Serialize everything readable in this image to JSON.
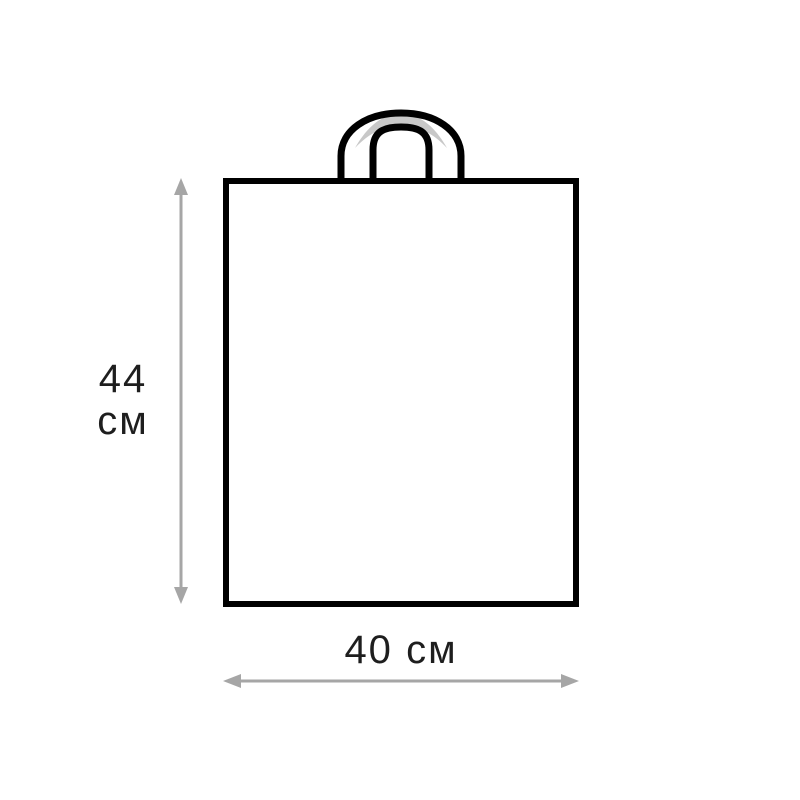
{
  "colors": {
    "outline": "#000000",
    "arrow": "#a6a6a6",
    "handle-fill": "#c8c8c8",
    "text": "#1e1e1e",
    "bg": "#ffffff"
  },
  "icons": {
    "bag": "shopping-bag-outline-icon",
    "handle": "bag-handle-icon",
    "vertical_arrow": "double-headed-vertical-arrow-icon",
    "horizontal_arrow": "double-headed-horizontal-arrow-icon"
  },
  "diagram": {
    "height_label": {
      "value": "44",
      "unit": "см"
    },
    "width_label": {
      "value": "40",
      "unit": "см"
    }
  }
}
